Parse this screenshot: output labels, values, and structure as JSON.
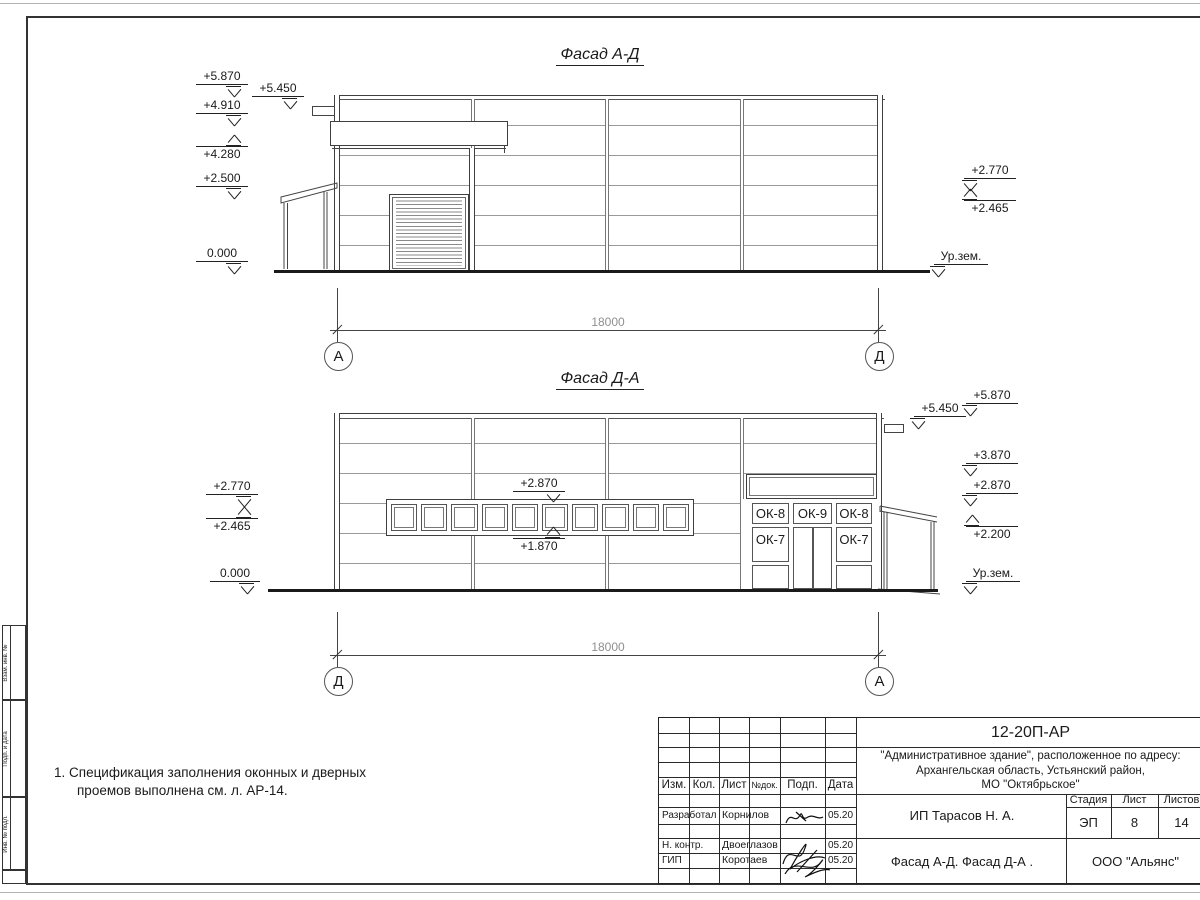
{
  "facade1": {
    "title": "Фасад А-Д",
    "dim": "18000",
    "axes": [
      "А",
      "Д"
    ],
    "marks_left": [
      "+5.870",
      "+5.450",
      "+4.910",
      "+4.280",
      "+2.500",
      "0.000"
    ],
    "marks_right": [
      "+2.770",
      "+2.465",
      "Ур.зем."
    ]
  },
  "facade2": {
    "title": "Фасад Д-А",
    "dim": "18000",
    "axes": [
      "Д",
      "А"
    ],
    "marks_left": [
      "+2.770",
      "+2.465",
      "0.000"
    ],
    "marks_right": [
      "+5.870",
      "+5.450",
      "+3.870",
      "+2.870",
      "+2.200",
      "Ур.зем."
    ],
    "marks_mid": [
      "+2.870",
      "+1.870"
    ],
    "windows": [
      "ОК-8",
      "ОК-9",
      "ОК-8",
      "ОК-7",
      "ОК-7"
    ]
  },
  "note": {
    "line1": "1. Спецификация заполнения оконных и дверных",
    "line2": "проемов выполнена см. л. АР-14."
  },
  "titleblock": {
    "code": "12-20П-АР",
    "address1": "\"Административное здание\", расположенное по адресу:",
    "address2": "Архангельская область, Устьянский район,",
    "address3": "МО \"Октябрьское\"",
    "col_izm": "Изм.",
    "col_kol": "Кол.",
    "col_list": "Лист",
    "col_ndok": "№док.",
    "col_podp": "Подп.",
    "col_data": "Дата",
    "row1_role": "Разработал",
    "row1_name": "Корнилов",
    "row1_date": "05.20",
    "row2_role": "Н. контр.",
    "row2_name": "Двоеглазов",
    "row2_date": "05.20",
    "row3_role": "ГИП",
    "row3_name": "Коротаев",
    "row3_date": "05.20",
    "client": "ИП Тарасов Н. А.",
    "stage_label": "Стадия",
    "sheet_label": "Лист",
    "sheets_label": "Листов",
    "stage": "ЭП",
    "sheet": "8",
    "sheets": "14",
    "doc_title": "Фасад А-Д. Фасад Д-А .",
    "company": "ООО \"Альянс\""
  },
  "sidestamp": {
    "cell1": "Взам. инв. №",
    "cell2": "Подп. и дата",
    "cell3": "Инв. № подл."
  }
}
